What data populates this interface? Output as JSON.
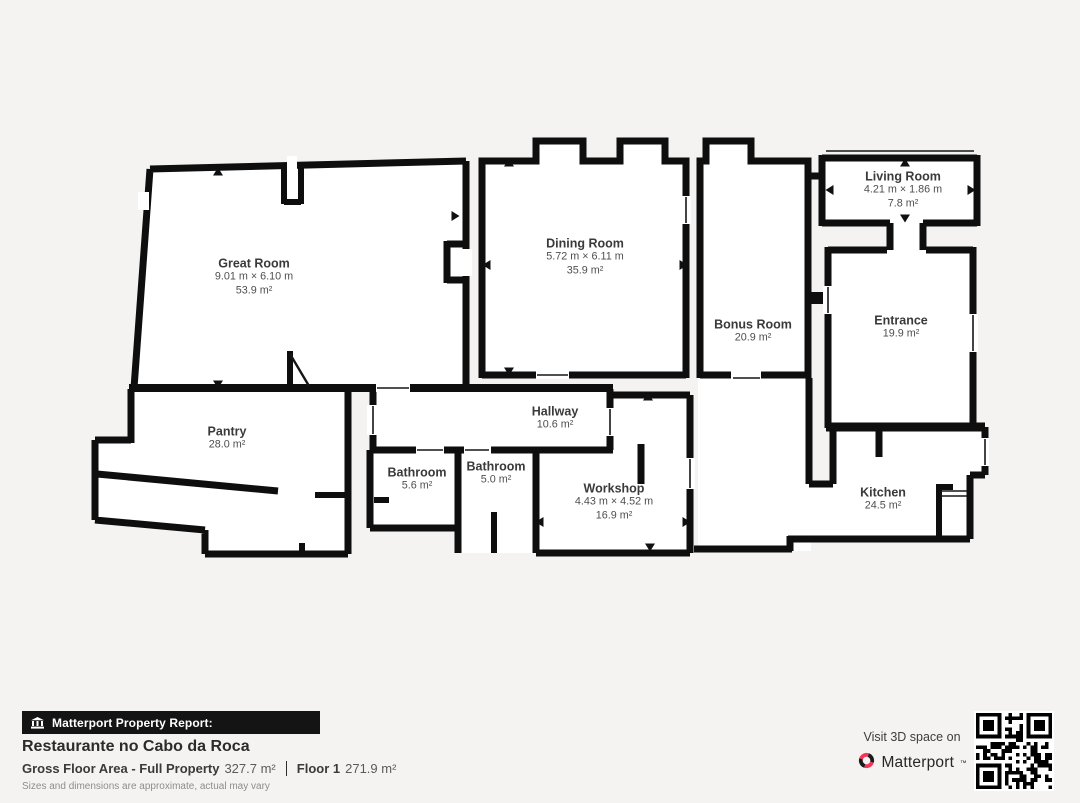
{
  "floor_plan": {
    "rooms": [
      {
        "id": "great-room",
        "name": "Great Room",
        "dims": "9.01 m × 6.10 m",
        "area": "53.9 m²"
      },
      {
        "id": "dining-room",
        "name": "Dining Room",
        "dims": "5.72 m × 6.11 m",
        "area": "35.9 m²"
      },
      {
        "id": "living-room",
        "name": "Living Room",
        "dims": "4.21 m × 1.86 m",
        "area": "7.8 m²"
      },
      {
        "id": "bonus-room",
        "name": "Bonus Room",
        "area": "20.9 m²"
      },
      {
        "id": "entrance",
        "name": "Entrance",
        "area": "19.9 m²"
      },
      {
        "id": "kitchen",
        "name": "Kitchen",
        "area": "24.5 m²"
      },
      {
        "id": "workshop",
        "name": "Workshop",
        "dims": "4.43 m × 4.52 m",
        "area": "16.9 m²"
      },
      {
        "id": "hallway",
        "name": "Hallway",
        "area": "10.6 m²"
      },
      {
        "id": "bathroom-1",
        "name": "Bathroom",
        "area": "5.6 m²"
      },
      {
        "id": "bathroom-2",
        "name": "Bathroom",
        "area": "5.0 m²"
      },
      {
        "id": "pantry",
        "name": "Pantry",
        "area": "28.0 m²"
      }
    ]
  },
  "report": {
    "badge": "Matterport Property Report:",
    "property_name": "Restaurante no Cabo da Roca",
    "gross_label": "Gross Floor Area - Full Property",
    "gross_value": "327.7 m²",
    "floor_label": "Floor 1",
    "floor_value": "271.9 m²",
    "disclaimer": "Sizes and dimensions are approximate, actual may vary"
  },
  "cta": {
    "visit_text": "Visit 3D space on",
    "brand": "Matterport",
    "trademark": "™"
  },
  "colors": {
    "background": "#f4f3f1",
    "walls": "#0e0e0e",
    "room_fill": "#ffffff",
    "brand_red": "#f43558",
    "badge_bg": "#141414"
  }
}
